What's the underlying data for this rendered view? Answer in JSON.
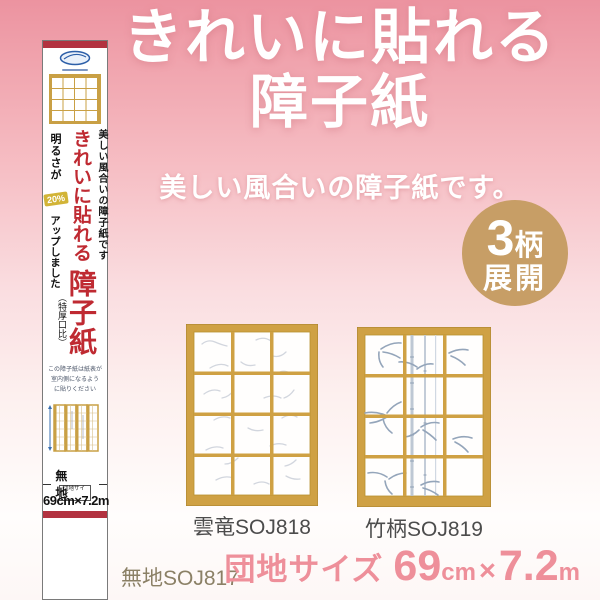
{
  "title": {
    "line1": "きれいに貼れる",
    "line2": "障子紙",
    "subtitle": "美しい風合いの障子紙です。"
  },
  "badge": {
    "count": "3",
    "unit": "柄",
    "word": "展開"
  },
  "package": {
    "tagline": "美しい風合いの障子紙です",
    "main_top": "きれいに貼れる",
    "main_bottom": "障子紙",
    "bright": "明るさが",
    "percent": "20%",
    "up": "アップしました",
    "note": "（特厚口比）",
    "caption": [
      "この障子紙は紙表が",
      "室内側になるよう",
      "に貼りください"
    ],
    "plain": "無 地",
    "size_label": "団地サイズ",
    "size_value": "69cm×7.2m"
  },
  "products": [
    {
      "label": "雲竜SOJ818"
    },
    {
      "label": "竹柄SOJ819"
    }
  ],
  "footer": {
    "plain_code": "無地SOJ817",
    "size_prefix": "団地サイズ",
    "num1": "69",
    "unit1": "cm",
    "times": "×",
    "num2": "7.2",
    "unit2": "m"
  },
  "colors": {
    "accent_pink": "#ee8f9a",
    "badge_tan": "#c79e66",
    "frame_gold": "#cfa144",
    "package_red": "#bf2a32",
    "band_red": "#b23240"
  }
}
